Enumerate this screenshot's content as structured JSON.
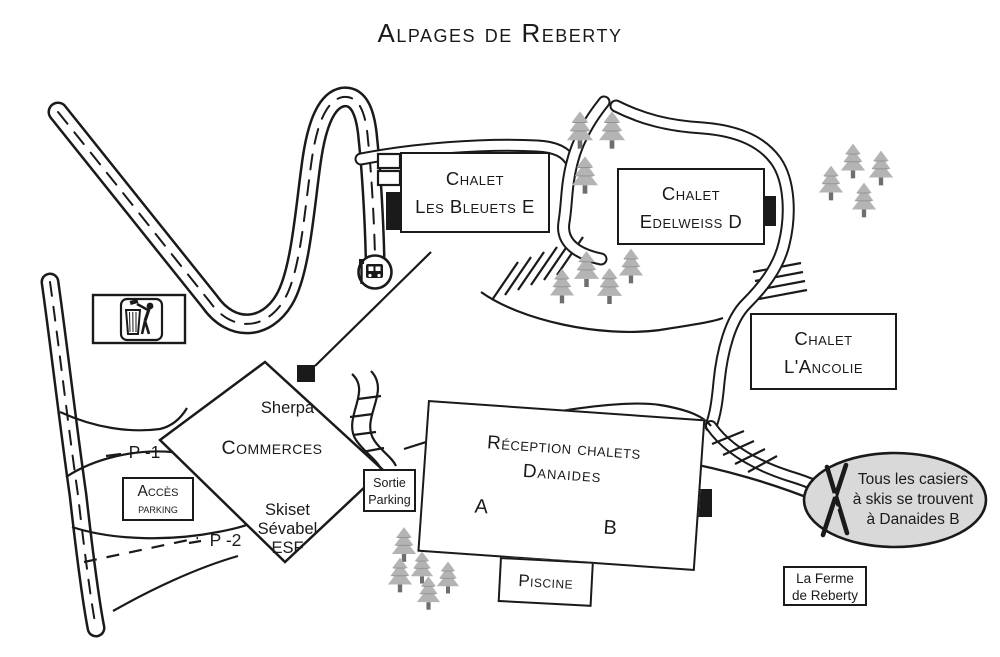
{
  "title": "Alpages de Reberty",
  "chalets": {
    "bleuets": {
      "line1": "Chalet",
      "line2": "Les Bleuets E"
    },
    "edelweiss": {
      "line1": "Chalet",
      "line2": "Edelweiss D"
    },
    "ancolie": {
      "line1": "Chalet",
      "line2": "L'Ancolie"
    }
  },
  "reception": {
    "line1": "Réception chalets",
    "line2": "Danaides",
    "wing_a": "A",
    "wing_b": "B"
  },
  "piscine": {
    "label": "Piscine"
  },
  "ferme": {
    "line1": "La Ferme",
    "line2": "de Reberty"
  },
  "commerces": {
    "shop1": "Sherpa",
    "title": "Commerces",
    "shop2": "Skiset",
    "shop3": "Sévabel",
    "shop4": "ESF"
  },
  "parking": {
    "acces_line1": "Accès",
    "acces_line2": "parking",
    "sortie_line1": "Sortie",
    "sortie_line2": "Parking",
    "level_p1": "P -1",
    "level_p2": "P -2"
  },
  "note_bubble": {
    "line1": "Tous les casiers",
    "line2": "à skis se trouvent",
    "line3": "à Danaides B"
  },
  "icons": {
    "bus_stop": "bus-stop-icon",
    "litter": "litter-bin-icon",
    "skis": "crossed-skis-icon",
    "tree": "fir-tree-icon"
  },
  "colors": {
    "line": "#1a1a1a",
    "tree_fill": "#b4b4b4",
    "tree_trunk": "#6e6e6e",
    "bubble_fill": "#d9d9d9",
    "background": "#ffffff"
  }
}
